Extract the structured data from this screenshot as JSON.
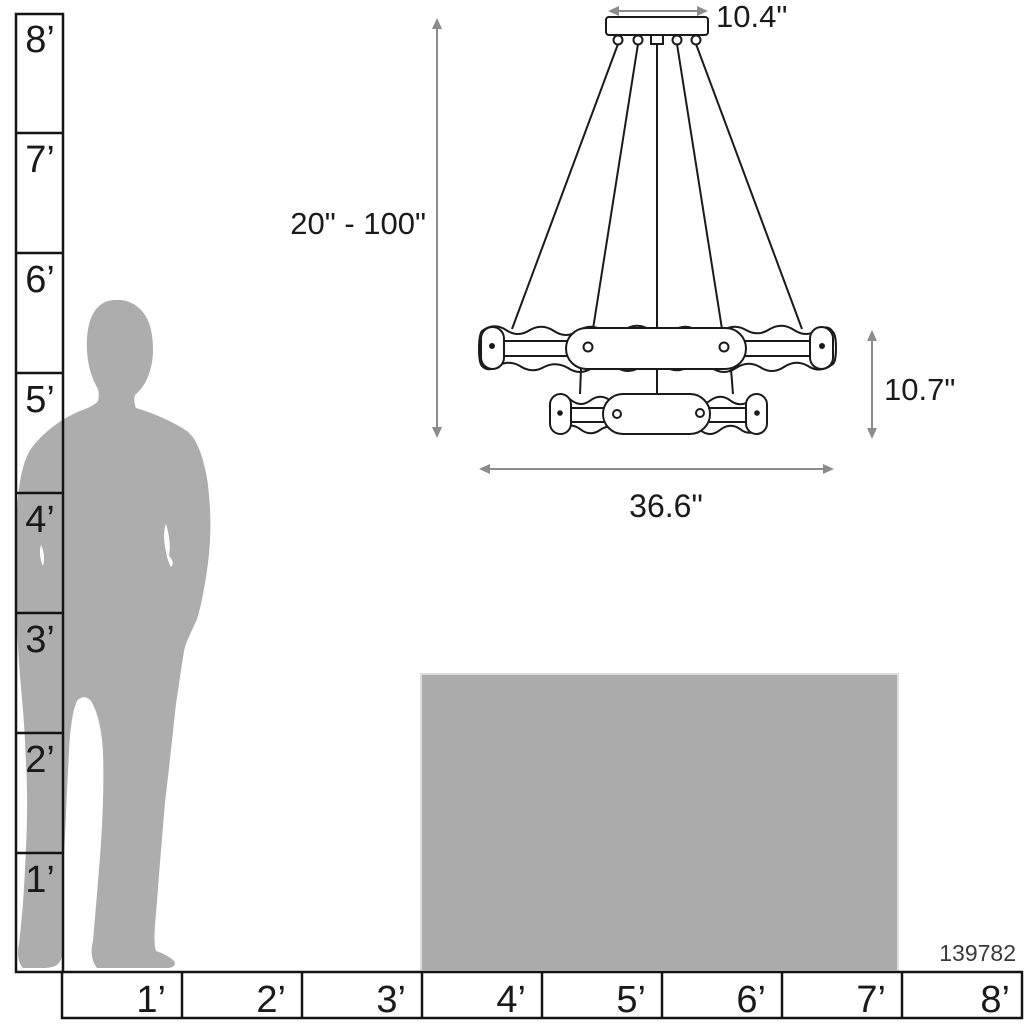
{
  "diagram_title": "Two-tier chandelier size reference diagram",
  "product": {
    "number": "139782"
  },
  "dimensions": {
    "canopy_width": "10.4\"",
    "suspension_range": "20\" - 100\"",
    "fixture_height": "10.7\"",
    "fixture_width": "36.6\""
  },
  "rulers": {
    "vertical": {
      "unit": "feet",
      "labels": [
        "8’",
        "7’",
        "6’",
        "5’",
        "4’",
        "3’",
        "2’",
        "1’"
      ]
    },
    "horizontal": {
      "unit": "feet",
      "labels": [
        "1’",
        "2’",
        "3’",
        "4’",
        "5’",
        "6’",
        "7’",
        "8’"
      ]
    }
  },
  "figures": {
    "person": "standing man silhouette (approx. 6 ft tall)",
    "table": "reference surface block approx. 3 ft high, spanning 4 ft to 7 ft"
  },
  "colors": {
    "background": "#ffffff",
    "silhouette": "#adadad",
    "table": "#ababab",
    "drawing_line": "#1a1a1a",
    "dimension_line": "#8c8c8c",
    "text": "#1a1a1a"
  }
}
